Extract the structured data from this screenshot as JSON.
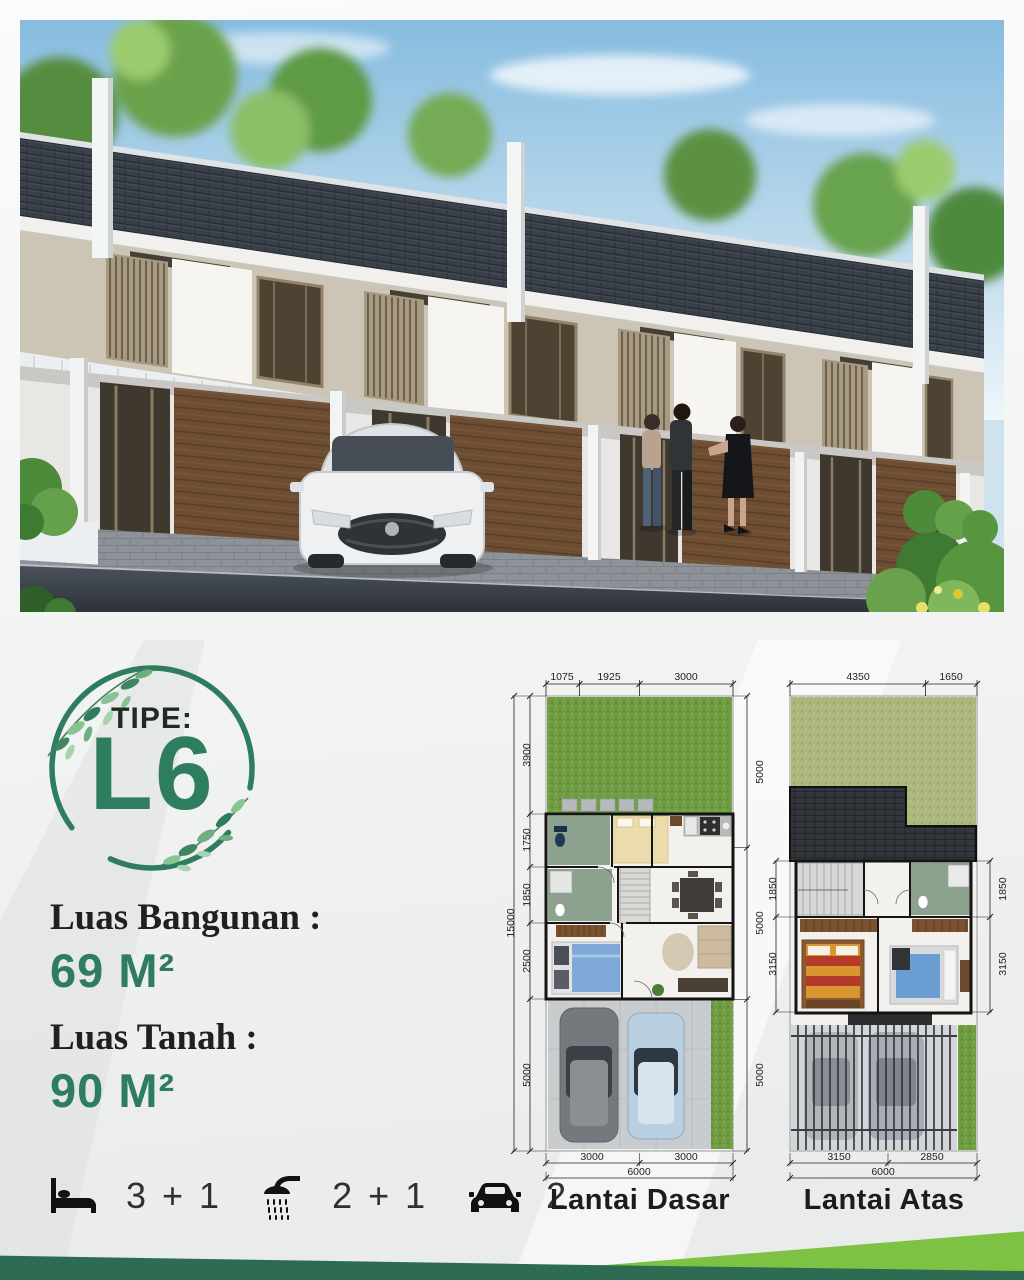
{
  "badge": {
    "label": "TIPE:",
    "value": "L6"
  },
  "specs": [
    {
      "label": "Luas Bangunan :",
      "value": "69 M²"
    },
    {
      "label": "Luas Tanah :",
      "value": "90 M²"
    }
  ],
  "features": [
    {
      "icon": "bed-icon",
      "value": "3 + 1"
    },
    {
      "icon": "shower-icon",
      "value": "2 + 1"
    },
    {
      "icon": "car-icon",
      "value": "2"
    }
  ],
  "floor_plans": [
    {
      "name": "Lantai Dasar",
      "dims": {
        "top": [
          "1075",
          "1925",
          "3000"
        ],
        "left": [
          "3900",
          "1750",
          "1850",
          "2500",
          "5000"
        ],
        "left_total": "15000",
        "right": [
          "5000",
          "5000",
          "5000"
        ],
        "bottom": [
          "3000",
          "3000"
        ],
        "bottom_total": "6000"
      }
    },
    {
      "name": "Lantai Atas",
      "dims": {
        "top": [
          "4350",
          "1650"
        ],
        "left": [
          "1850",
          "3150"
        ],
        "right": [
          "1850",
          "3150"
        ],
        "bottom": [
          "3150",
          "2850"
        ],
        "bottom_total": "6000"
      }
    }
  ],
  "colors": {
    "accent_green": "#2e7d5e",
    "light_green": "#7dc243",
    "footer_green": "#2d6b53",
    "lawn_green": "#6f9b43",
    "roof_dark": "#3a4049"
  }
}
